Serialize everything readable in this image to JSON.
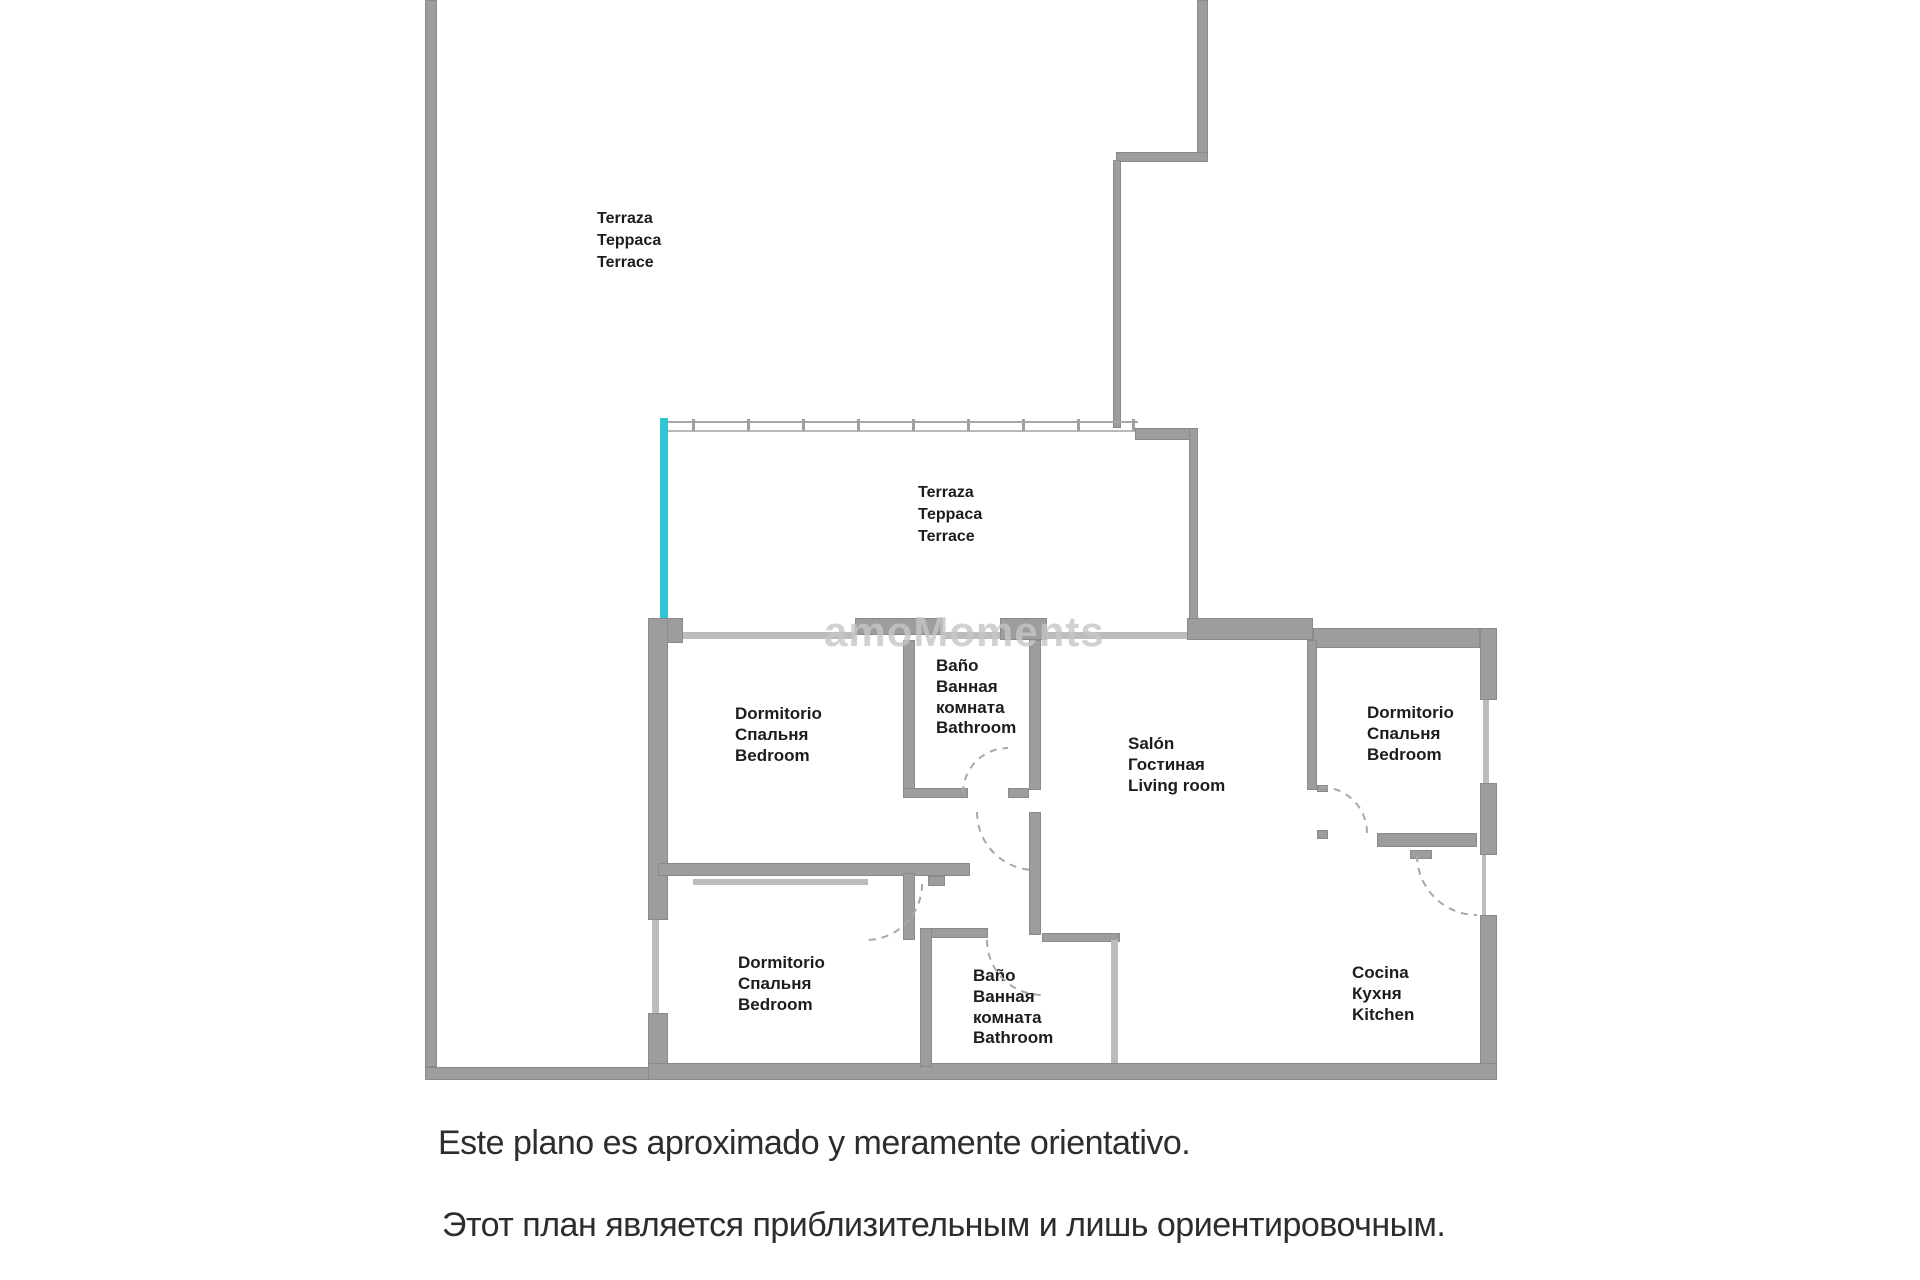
{
  "title": "Floor plan",
  "colors": {
    "wall": "#9d9d9d",
    "window_line": "#bcbcbc",
    "glass_edge": "#2fc4d6",
    "label_text": "#1d1d1d",
    "disclaimer_text": "#2d2d2d",
    "door_arc": "#a8a8a8",
    "watermark": "#c6c6c6"
  },
  "watermark": {
    "text": "amoMoments"
  },
  "rooms": {
    "terrace_top": {
      "l1": "Terraza",
      "l2": "Терраса",
      "l3": "Terrace"
    },
    "terrace_mid": {
      "l1": "Terraza",
      "l2": "Терраса",
      "l3": "Terrace"
    },
    "bedroom_nw": {
      "l1": "Dormitorio",
      "l2": "Спальня",
      "l3": "Bedroom"
    },
    "bathroom_top": {
      "l1": "Baño",
      "l2": "Ванная",
      "l3": "комната",
      "l4": "Bathroom"
    },
    "salon": {
      "l1": "Salón",
      "l2": "Гостиная",
      "l3": "Living room"
    },
    "bedroom_e": {
      "l1": "Dormitorio",
      "l2": "Спальня",
      "l3": "Bedroom"
    },
    "bedroom_sw": {
      "l1": "Dormitorio",
      "l2": "Спальня",
      "l3": "Bedroom"
    },
    "bathroom_bot": {
      "l1": "Baño",
      "l2": "Ванная",
      "l3": "комната",
      "l4": "Bathroom"
    },
    "kitchen": {
      "l1": "Cocina",
      "l2": "Кухня",
      "l3": "Kitchen"
    }
  },
  "disclaimer": {
    "line1": "Este plano es aproximado y meramente orientativo.",
    "line2": "Этот план является приблизительным и лишь ориентировочным."
  }
}
